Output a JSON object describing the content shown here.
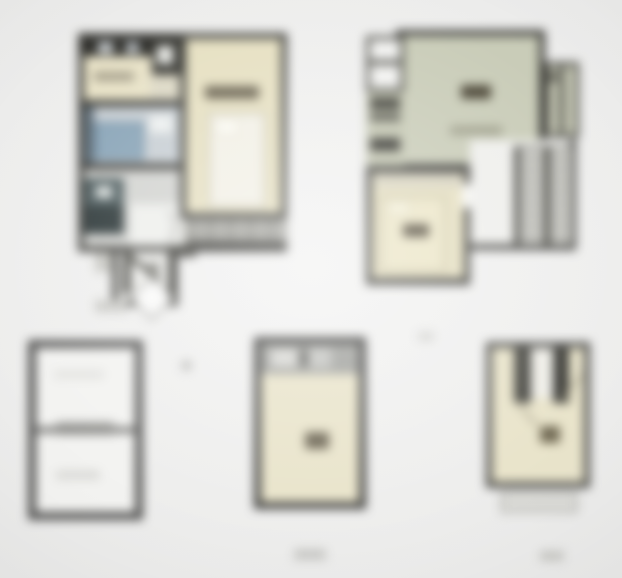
{
  "sheet": {
    "kind": "blurred-floor-plan-sheet",
    "plan_count": 5,
    "visible_text": [],
    "labels_note": "illegible"
  },
  "palette": {
    "background": "#ebebea",
    "wall": "#3e3e3a",
    "cream": "#e6e0c2",
    "cream_light": "#e9e4cb",
    "sage": "#c9ccb8",
    "sage_dark": "#c3c6b1",
    "bath_blue": "#8aa5b8",
    "bath_floor": "#c8cfd4",
    "floor_gray": "#d6d6d1",
    "paper_white": "#f2f2f0",
    "stair_gray": "#90908a",
    "teal_fixture": "#4d5c5e",
    "label_smudge": "#564f3e",
    "balcony_gray": "#a8a8a2",
    "header_gray": "#a2a39f"
  },
  "plans": [
    {
      "id": "top-left-apartment",
      "rooms": [
        "kitchen",
        "bathroom",
        "hallway",
        "bedroom",
        "balcony",
        "entry-stair"
      ],
      "fixtures": [
        "kitchen-counter",
        "fridge",
        "bathtub",
        "sink",
        "washer",
        "double-bed",
        "door-swing"
      ],
      "labels": [
        {
          "room": "bedroom",
          "illegible": true
        },
        {
          "room": "kitchen",
          "illegible": true
        }
      ]
    },
    {
      "id": "top-right-apartment",
      "rooms": [
        "living-room",
        "kitchen-column",
        "small-rooms-top-left",
        "side-rooms-right",
        "bedroom",
        "staircase"
      ],
      "fixtures": [
        "kitchen-counters",
        "double-bed",
        "stair-flights"
      ],
      "labels": [
        {
          "room": "living-room",
          "illegible": true
        },
        {
          "room": "bedroom",
          "illegible": true
        }
      ]
    },
    {
      "id": "bottom-left-unfurnished-plan",
      "rooms": [
        "upper-room",
        "lower-room"
      ],
      "fixtures": [
        "middle-divider-wall"
      ],
      "labels": [
        {
          "room": "upper-room",
          "illegible": true
        },
        {
          "room": "lower-room",
          "illegible": true
        }
      ]
    },
    {
      "id": "bottom-middle-room-plan",
      "rooms": [
        "header-strip",
        "main-room"
      ],
      "fixtures": [
        "cabinet-blobs"
      ],
      "labels": [
        {
          "room": "main-room",
          "illegible": true
        }
      ]
    },
    {
      "id": "bottom-right-attic-room-plan",
      "rooms": [
        "main-room",
        "balcony-below"
      ],
      "fixtures": [
        "roof-slope-strips"
      ],
      "labels": [
        {
          "room": "main-room",
          "illegible": true
        }
      ]
    }
  ]
}
